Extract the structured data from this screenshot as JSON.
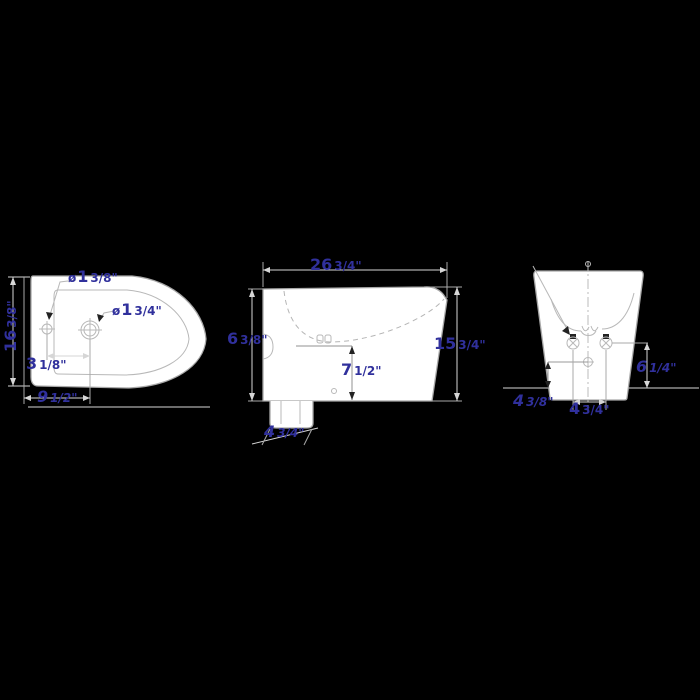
{
  "image_type": "technical dimensional drawing",
  "subject": "bidet fixture - three orthographic views (top, side, rear)",
  "colors": {
    "background": "#000000",
    "outline": "#a8a8a8",
    "dimension_line": "#d6d6d6",
    "dimension_text": "#30309c",
    "fixture_fill": "#ffffff"
  },
  "views": {
    "top": {
      "label": "top view",
      "dims": {
        "hole_small_diameter": {
          "prefix": "ø",
          "whole": "1",
          "frac": "3/8\""
        },
        "hole_large_diameter": {
          "prefix": "ø",
          "whole": "1",
          "frac": "3/4\""
        },
        "overall_width": {
          "whole": "16",
          "frac": "3/8\""
        },
        "hole_spacing": {
          "whole": "3",
          "frac": "1/8\""
        },
        "hole_offset": {
          "whole": "9",
          "frac": "1/2\""
        }
      }
    },
    "side": {
      "label": "side view",
      "dims": {
        "overall_length": {
          "whole": "26",
          "frac": "3/4\""
        },
        "rim_height_left": {
          "whole": "6",
          "frac": "3/8\""
        },
        "overall_height": {
          "whole": "15",
          "frac": "3/4\""
        },
        "bowl_depth": {
          "whole": "7",
          "frac": "1/2\""
        },
        "outlet_offset": {
          "whole": "4",
          "frac": "3/4\""
        }
      }
    },
    "rear": {
      "label": "rear view",
      "dims": {
        "inlet_height": {
          "whole": "6",
          "frac": "1/4\""
        },
        "outlet_height": {
          "whole": "4",
          "frac": "3/8\""
        },
        "inlet_spacing": {
          "whole": "4",
          "frac": "3/4\""
        }
      }
    }
  }
}
